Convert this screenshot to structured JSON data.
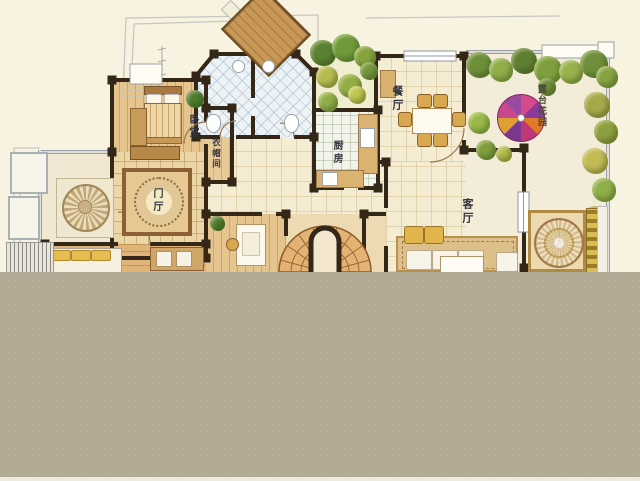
{
  "plan": {
    "type": "residential-floor-plan",
    "rooms": {
      "dining": "餐厅",
      "kitchen": "厨房",
      "living": "客厅",
      "bedroom": "卧室",
      "cloakroom": "衣帽间",
      "foyer": "门厅",
      "terrace_garden": "露台花园"
    },
    "palette": {
      "paper": "#f8f3e0",
      "wall_dark": "#342718",
      "wall_light": "#9aa0a8",
      "wood": "#d9a968",
      "tile": "#edf2f5",
      "greenery": "#7a9a3a",
      "umbrella": [
        "#cc3f86",
        "#7c3f9e",
        "#e09030",
        "#c84890"
      ],
      "gray_cover": "#b3aa96"
    }
  }
}
